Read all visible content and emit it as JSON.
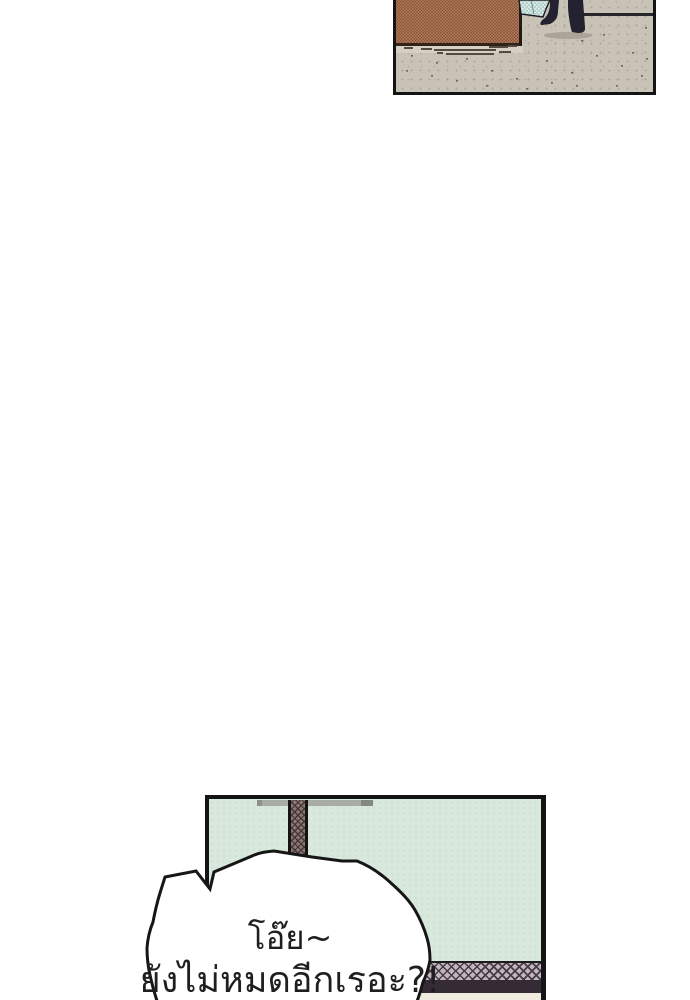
{
  "comic": {
    "bubble": {
      "line1": "โอ๊ย~",
      "line2": "ยังไม่หมดอีกเรอะ?!"
    },
    "colors": {
      "page-bg": "#ffffff",
      "panel-border": "#141414",
      "pavement": "#c9c2b7",
      "wall-orange": "#dfa377",
      "wall-dot": "#7b4b35",
      "wall-base": "#30231a",
      "wall-base-strip": "#d6cfc4",
      "fabric-teal": "#b5d3cb",
      "fabric-check": "#e9f3ef",
      "legs-dark": "#232230",
      "shadow-warm": "#a79e94",
      "mint-wall": "#d9e8dd",
      "beam-gray": "#a9aba5",
      "pillar-base": "#8c7772",
      "pillar-hatch": "#463638",
      "band-base": "#c2b6be",
      "band-hatch": "#463a46",
      "band-dark": "#352b35",
      "floor-cream": "#efebde",
      "bubble-fill": "#ffffff",
      "bubble-stroke": "#161616",
      "text": "#1f1f1f"
    }
  }
}
